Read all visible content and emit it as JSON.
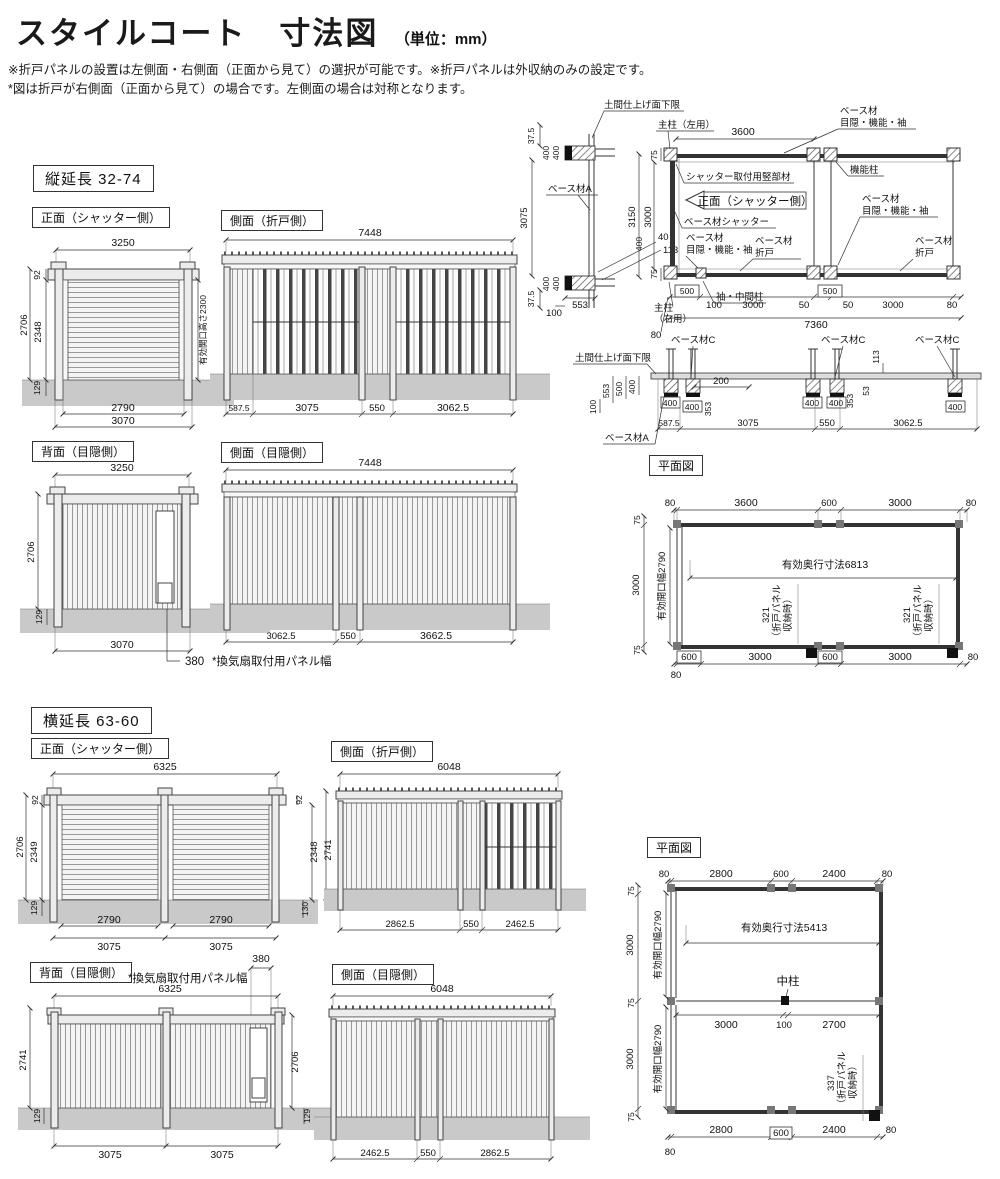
{
  "header": {
    "title": "スタイルコート　寸法図",
    "unit": "（単位：mm）"
  },
  "notes": {
    "l1": "※折戸パネルの設置は左側面・右側面（正面から見て）の選択が可能です。※折戸パネルは外収納のみの設定です。",
    "l2": "*図は折戸が右側面（正面から見て）の場合です。左側面の場合は対称となります。"
  },
  "sec": {
    "s1": "縦延長 32-74",
    "s2": "横延長 63-60"
  },
  "t": {
    "front": "正面（シャッター側）",
    "sideFold": "側面（折戸側）",
    "back": "背面（目隠側）",
    "sidePriv": "側面（目隠側）",
    "plan": "平面図",
    "openH": "有効開口高さ2300",
    "openW": "有効開口幅2790",
    "vent": "*換気扇取付用パネル幅",
    "naka": "中柱",
    "n321": "321",
    "n337": "337",
    "fp1": "（折戸パネル",
    "fp2": "収納時）",
    "base": "ベース材",
    "mfs": "目隠・機能・袖",
    "fold": "折戸",
    "baseA": "ベース材A",
    "baseC": "ベース材C",
    "baseShutter": "ベース材シャッター",
    "doma": "土間仕上げ面下限",
    "postL": "主柱（左用）",
    "postR1": "主柱",
    "postR2": "（右用）",
    "funcPost": "機能柱",
    "shMember": "シャッター取付用竪部材",
    "sode": "袖・中間柱"
  },
  "a1": {
    "w": "3250",
    "h92": "92",
    "h2706": "2706",
    "h2348": "2348",
    "h129": "129",
    "inner": "2790",
    "outer": "3070"
  },
  "a2": {
    "w": "7448",
    "s1": "587.5",
    "s2": "3075",
    "s3": "550",
    "s4": "3062.5"
  },
  "a3": {
    "w": "3250",
    "h2706": "2706",
    "h129": "129",
    "b": "3070",
    "v380": "380"
  },
  "a4": {
    "w": "7448",
    "s1": "3062.5",
    "s2": "550",
    "s3": "3662.5"
  },
  "b": {
    "d37t": "37.5",
    "d400": "400",
    "d3075": "3075",
    "d40": "40",
    "d113": "113",
    "d37b": "37.5",
    "d553": "553",
    "d100": "100",
    "d3600": "3600",
    "d75t": "75",
    "d3150": "3150",
    "d3000v": "3000",
    "d75b": "75",
    "d500": "500",
    "d100b": "100",
    "d3000a": "3000",
    "d50a": "50",
    "d50b": "50",
    "d3000b": "3000",
    "d80r": "80",
    "d7360": "7360",
    "d80b": "80"
  },
  "c": {
    "d553": "553",
    "d500": "500",
    "d400": "400",
    "d100": "100",
    "d200": "200",
    "d353": "353",
    "d53": "53",
    "d113": "113",
    "s1": "587.5",
    "s2": "3075",
    "s3": "550",
    "s4": "3062.5"
  },
  "d": {
    "t80l": "80",
    "t3600": "3600",
    "t600": "600",
    "t3000": "3000",
    "t80r": "80",
    "l75t": "75",
    "l3000": "3000",
    "l75b": "75",
    "l80": "80",
    "depth": "有効奥行寸法6813",
    "b600a": "600",
    "b3000a": "3000",
    "b600b": "600",
    "b3000b": "3000",
    "b80": "80"
  },
  "e1": {
    "w": "6325",
    "l92": "92",
    "l2706": "2706",
    "l2349": "2349",
    "l129": "129",
    "r92": "92",
    "r2348": "2348",
    "r2741": "2741",
    "r130": "130",
    "inner": "2790",
    "outer": "3075"
  },
  "e2": {
    "w": "6048",
    "s1": "2862.5",
    "s2": "550",
    "s3": "2462.5"
  },
  "e3": {
    "w": "6325",
    "v380": "380",
    "l2741": "2741",
    "l129": "129",
    "r2706": "2706",
    "r129": "129",
    "s1": "3075",
    "s2": "3075"
  },
  "e4": {
    "w": "6048",
    "s1": "2462.5",
    "s2": "550",
    "s3": "2862.5"
  },
  "f": {
    "t80l": "80",
    "t2800": "2800",
    "t600": "600",
    "t2400": "2400",
    "t80r": "80",
    "l75a": "75",
    "l3000a": "3000",
    "l75b": "75",
    "l3000b": "3000",
    "l75c": "75",
    "depth": "有効奥行寸法5413",
    "m3000": "3000",
    "m100": "100",
    "m2700": "2700",
    "b2800": "2800",
    "b600": "600",
    "b2400": "2400",
    "b80": "80",
    "bl80": "80"
  }
}
